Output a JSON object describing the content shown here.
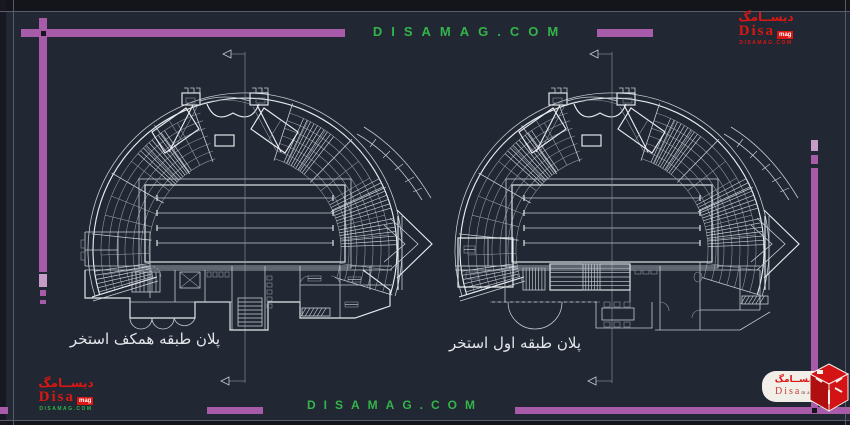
{
  "watermarks": {
    "top": "DISAMAG.COM",
    "bottom": "DISAMAG.COM"
  },
  "plans": [
    {
      "label": "پلان طبقه همکف استخر"
    },
    {
      "label": "پلان طبقه اول استخر"
    }
  ],
  "logo": {
    "arabic": "دیســامگ",
    "name": "Disa",
    "suffix": "mag",
    "site": "DISAMAG.COM"
  },
  "colors": {
    "background": "#212733",
    "frame_line": "#565c68",
    "accent_purple": "#a85ba8",
    "watermark_green": "#34b44a",
    "logo_red": "#da1712",
    "drawing_line": "#c6cbd3"
  }
}
